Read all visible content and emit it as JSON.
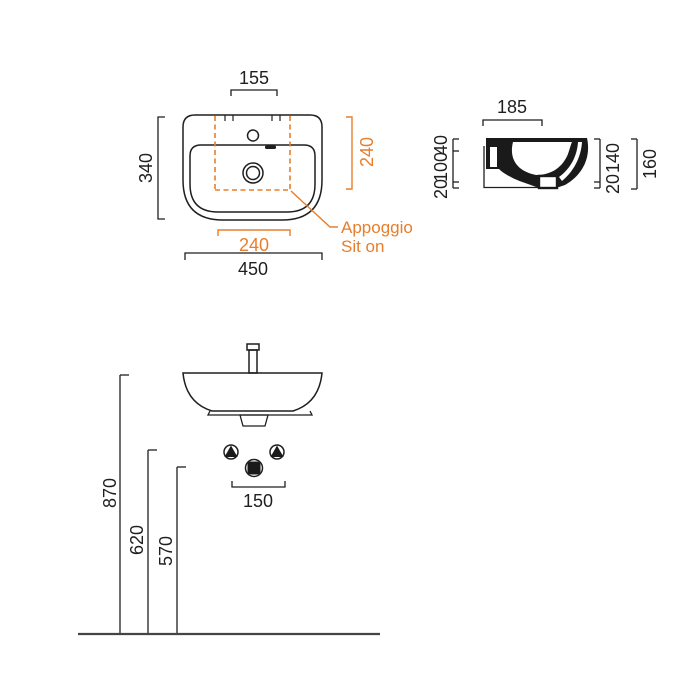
{
  "title": "Washbasin technical dimension drawing",
  "colors": {
    "accent": "#E87E2B",
    "line": "#1F1F1F",
    "floor": "#444444"
  },
  "plan_view": {
    "tap_hole_span": "155",
    "depth": "340",
    "sit_on_depth": "240",
    "sit_on_width": "240",
    "width": "450",
    "note_line1": "Appoggio",
    "note_line2": "Sit on"
  },
  "section_view": {
    "top_width": "185",
    "left_dim_top": "40",
    "left_dim_middle": "100",
    "left_dim_bottom": "20",
    "right_dim_upper": "140",
    "right_dim_lower": "20",
    "right_dim_total": "160"
  },
  "front_view": {
    "height_tap": "870",
    "height_rim": "620",
    "height_drain": "570",
    "connection_spacing": "150"
  }
}
